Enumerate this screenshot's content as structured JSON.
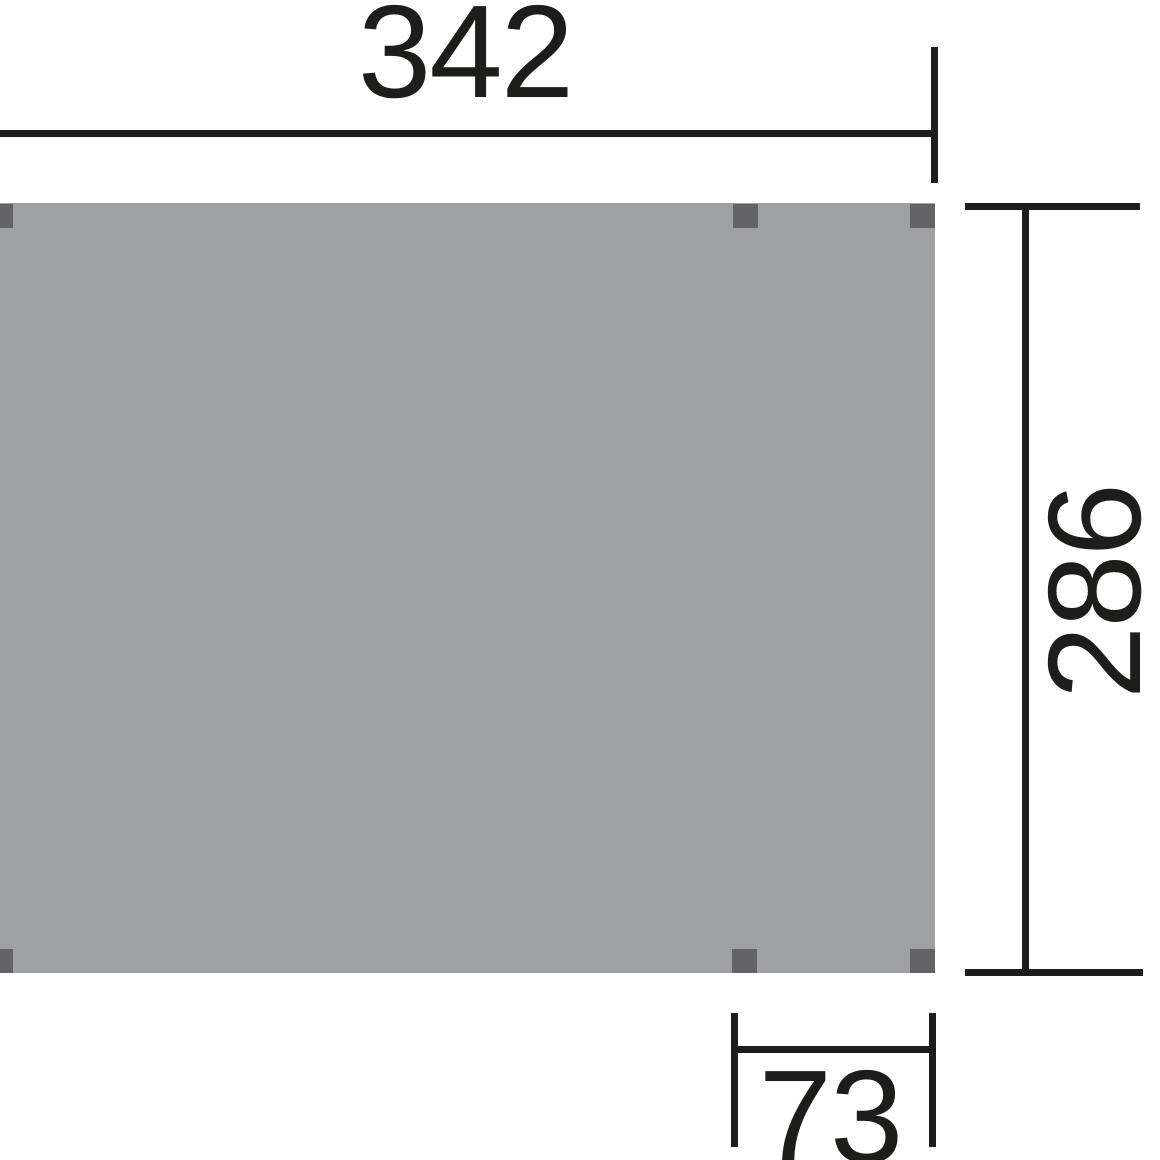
{
  "diagram": {
    "title": "Dimensioned plan view of flat-roof canopy surface",
    "type": "technical-dimension-drawing",
    "visible_posts": 6
  },
  "dimensions": {
    "width": {
      "value": "342",
      "position": "top",
      "orientation": "horizontal"
    },
    "depth": {
      "value": "286",
      "position": "right",
      "orientation": "vertical-rotated"
    },
    "offset": {
      "value": "73",
      "position": "bottom",
      "orientation": "horizontal"
    }
  },
  "colors": {
    "background": "#ffffff",
    "surface": "#9ea0a2",
    "post": "#636366",
    "line": "#1d1d1b"
  }
}
